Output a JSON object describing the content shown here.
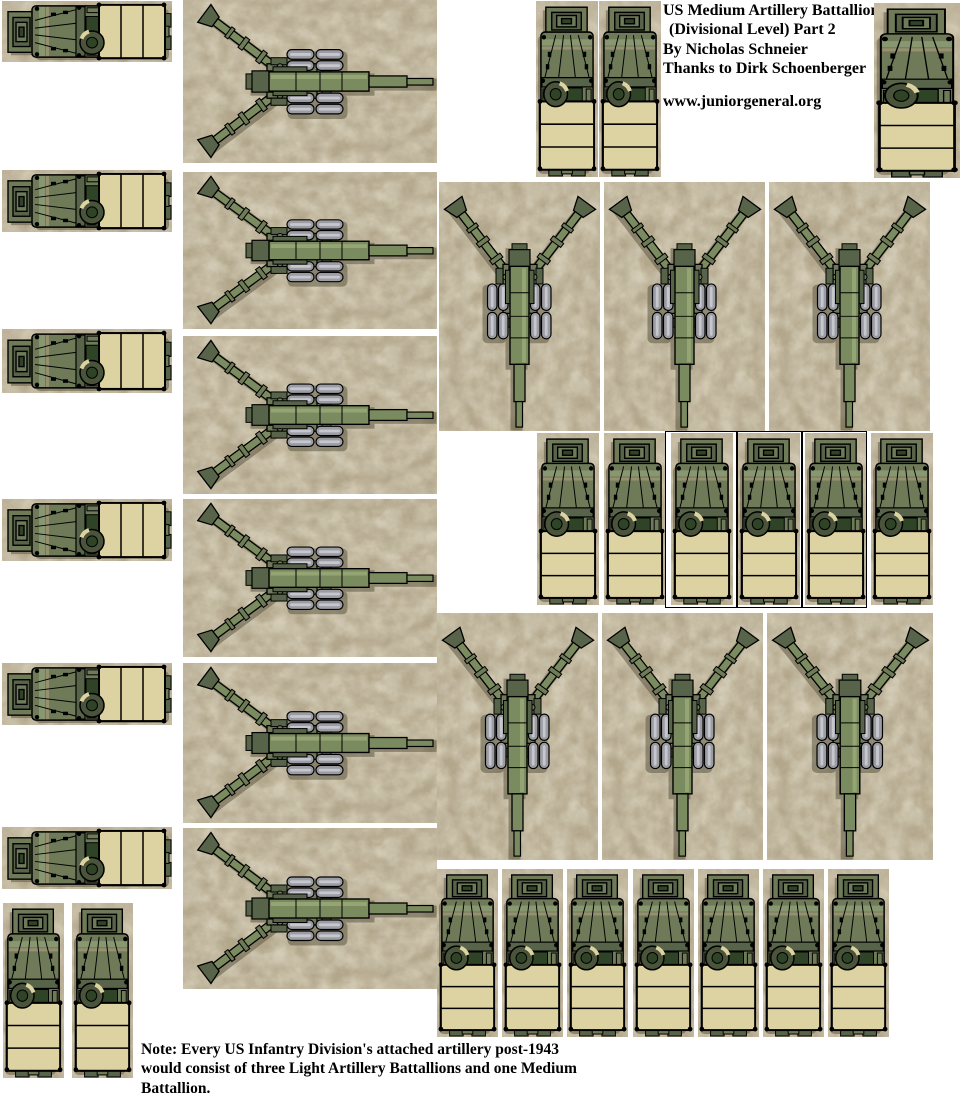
{
  "page": {
    "width": 962,
    "height": 1096,
    "background": "#ffffff"
  },
  "header": {
    "lines": [
      "US Medium Artillery Battallion",
      "(Divisional Level) Part 2",
      "By Nicholas Schneier",
      "Thanks to Dirk Schoenberger"
    ],
    "website": "www.juniorgeneral.org"
  },
  "note": {
    "lines": [
      "Note: Every US Infantry Division's attached artillery post-1943",
      "would consist of three Light Artillery Battallions and one Medium",
      "Battallion."
    ]
  },
  "units": {
    "truck": {
      "label": "6x6 artillery tractor truck, top view",
      "count": 24
    },
    "howitzer": {
      "label": "155mm medium howitzer, top view",
      "count": 12
    }
  },
  "groups": [
    {
      "name": "left-truck-column",
      "unit": "truck",
      "count": 6
    },
    {
      "name": "left-howitzer-column",
      "unit": "howitzer",
      "count": 6
    },
    {
      "name": "top-right-trucks",
      "unit": "truck",
      "count": 3
    },
    {
      "name": "howitzer-row-1",
      "unit": "howitzer",
      "count": 3
    },
    {
      "name": "truck-row-1",
      "unit": "truck",
      "count": 6
    },
    {
      "name": "howitzer-row-2",
      "unit": "howitzer",
      "count": 3
    },
    {
      "name": "truck-row-2",
      "unit": "truck",
      "count": 7
    },
    {
      "name": "bottom-left-trucks",
      "unit": "truck",
      "count": 2
    }
  ],
  "colors": {
    "page_bg": "#ffffff",
    "stone_base": "#b3a78b",
    "bed_tan": "#ddd2a2",
    "olive": "#6e7a58",
    "olive_dark": "#586449",
    "olive_deep": "#2f4426",
    "olive_light": "#8c9a74",
    "tire": "#49543a",
    "wheel_gray": "#9c9ca4",
    "wheel_light": "#c6c6cd",
    "barrel_green": "#7b8b60",
    "barrel_hi": "#94a473",
    "ink": "#000000"
  }
}
